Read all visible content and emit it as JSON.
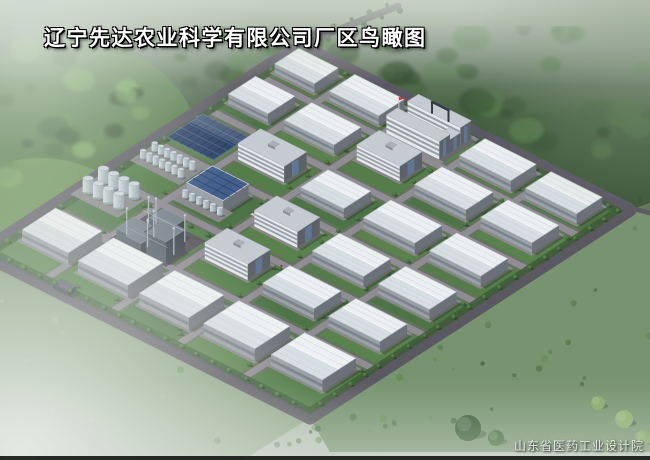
{
  "title": "辽宁先达农业科学有限公司厂区鸟瞰图",
  "credit": "山东省医药工业设计院",
  "palette": {
    "roadOuter": "#56525d",
    "roadInner": "#8e8a94",
    "siteBase": "#5e7054",
    "lawns": [
      "#4e7a42",
      "#477040",
      "#557f48"
    ],
    "hedge": "#36572e",
    "roofTop": "#f2f5f8",
    "roofBottom": "#dde3e9",
    "roofEdge": "#aeb5bd",
    "roofSeam": "#c6cdd5",
    "wallLight": "#9aa0a8",
    "wallDark": "#686d76",
    "windowBand": "#5d6570",
    "slabWall": "#eceef1",
    "slabEnd": "#575c64",
    "slabRoof": "#c9cfd5",
    "slabBand": "#828c97",
    "glass": "#5a7fa8",
    "solarDark": "#233a63",
    "solarLine": "#3b5e96",
    "solarGrid": "#16233f",
    "solarEdge": "#55688f",
    "panelRoof": "#3c5a8c",
    "panelSeam": "#24375c",
    "tankTop": "#d3dce3",
    "tankEdge": "#93a0ab",
    "tankBody2": "#8fa0ac",
    "plantMid": "#59626e",
    "plantDark": "#3c434d",
    "plantRoof": "#77818d",
    "pipe": "#a8b4c0",
    "courtyard": "#e9e2b0",
    "courtyardInner": "#d9cf92",
    "apron": "#8e8a92",
    "shadow": "rgba(22,32,22,0.32)",
    "forest": [
      "#263f24",
      "#2f4c2b",
      "#3a5a33",
      "#456a3a",
      "#52794a"
    ],
    "brightField": [
      "#55813f",
      "#68954f",
      "#7fae60"
    ],
    "fieldGreen": "#75926c",
    "bushGreens": [
      "#3f6436",
      "#4e7442",
      "#5d8a4a"
    ],
    "flagRed": "#d42b1f",
    "gateDark": "#2e333a",
    "fogPale": "#e6ece6"
  },
  "scene": {
    "transform": {
      "ox": 300,
      "oy": 45,
      "ax": 3.3,
      "ay": 1.65,
      "bx": -3.2,
      "by": 2.08
    },
    "roads_a": [
      18,
      38,
      58,
      78
    ],
    "roads_b": [
      14,
      30,
      46,
      62,
      78
    ],
    "grid_a": [
      0,
      18,
      38,
      58,
      78,
      100
    ],
    "grid_b": [
      0,
      14,
      30,
      46,
      62,
      78,
      100
    ],
    "buildings": [
      {
        "t": "wh",
        "a": 3,
        "b": 3.5,
        "w": 12,
        "d": 7.5,
        "h": 9
      },
      {
        "t": "wh",
        "a": 19.5,
        "b": 3,
        "w": 15,
        "d": 8,
        "h": 9
      },
      {
        "t": "wh",
        "a": 59,
        "b": 3,
        "w": 15.5,
        "d": 8,
        "h": 10
      },
      {
        "t": "wh",
        "a": 79,
        "b": 3,
        "w": 15.5,
        "d": 8,
        "h": 10
      },
      {
        "t": "wh",
        "a": 3,
        "b": 17,
        "w": 12,
        "d": 8.5,
        "h": 9
      },
      {
        "t": "wh",
        "a": 19.5,
        "b": 16.5,
        "w": 15,
        "d": 8.5,
        "h": 9
      },
      {
        "t": "slab",
        "a": 40,
        "b": 16.5,
        "w": 13,
        "d": 7,
        "h": 15
      },
      {
        "t": "wh",
        "a": 59,
        "b": 16.5,
        "w": 15.5,
        "d": 8.5,
        "h": 10
      },
      {
        "t": "wh",
        "a": 79,
        "b": 16.5,
        "w": 15.5,
        "d": 8.5,
        "h": 10
      },
      {
        "t": "slab",
        "a": 19.5,
        "b": 32.5,
        "w": 14,
        "d": 7,
        "h": 16
      },
      {
        "t": "wh",
        "a": 40,
        "b": 32.5,
        "w": 13,
        "d": 8.5,
        "h": 9
      },
      {
        "t": "wh",
        "a": 59,
        "b": 32.5,
        "w": 15.5,
        "d": 8.5,
        "h": 10
      },
      {
        "t": "wh",
        "a": 79,
        "b": 32.5,
        "w": 15.5,
        "d": 8.5,
        "h": 10
      },
      {
        "t": "slab",
        "a": 40,
        "b": 48.5,
        "w": 13,
        "d": 7,
        "h": 16
      },
      {
        "t": "wh",
        "a": 59,
        "b": 48.5,
        "w": 15.5,
        "d": 8.5,
        "h": 10
      },
      {
        "t": "wh",
        "a": 79,
        "b": 48.5,
        "w": 15.5,
        "d": 8.5,
        "h": 10
      },
      {
        "t": "slab",
        "a": 40,
        "b": 64,
        "w": 13,
        "d": 7,
        "h": 16
      },
      {
        "t": "wh",
        "a": 59,
        "b": 64,
        "w": 15.5,
        "d": 8.5,
        "h": 10
      },
      {
        "t": "wh",
        "a": 79,
        "b": 64,
        "w": 15.5,
        "d": 8.5,
        "h": 10
      },
      {
        "t": "whb",
        "a": 4,
        "b": 80.5,
        "w": 14,
        "d": 10.5,
        "h": 11
      },
      {
        "t": "whb",
        "a": 22,
        "b": 81,
        "w": 15,
        "d": 11,
        "h": 12
      },
      {
        "t": "whb",
        "a": 41,
        "b": 81.5,
        "w": 15,
        "d": 11,
        "h": 12
      },
      {
        "t": "whb",
        "a": 60,
        "b": 81,
        "w": 15.5,
        "d": 11,
        "h": 12
      },
      {
        "t": "whb",
        "a": 79.5,
        "b": 80.5,
        "w": 15.5,
        "d": 10.5,
        "h": 11
      }
    ],
    "office": {
      "a": 38,
      "b": 2.2,
      "w": 16,
      "slabD": 3.4,
      "gap": 3.2,
      "h": 18,
      "connW": 3.2,
      "connH": 13
    },
    "gate": {
      "a1": 40.5,
      "a2": 45.5,
      "h": 11
    },
    "solar": {
      "a": 1.5,
      "b": 32,
      "w": 14,
      "d": 11
    },
    "panelroof": {
      "a": 20,
      "b": 48,
      "w": 11,
      "d": 8,
      "h": 12
    },
    "plant": {
      "a": 19,
      "b": 66.5,
      "w": 16,
      "d": 11.5,
      "parts": [
        {
          "da": 0.5,
          "db": 5.5,
          "w": 5.5,
          "d": 5.5,
          "h": 10
        },
        {
          "da": 5,
          "db": 0.8,
          "w": 6.5,
          "d": 4.5,
          "h": 16
        },
        {
          "da": 9.5,
          "db": 5,
          "w": 6,
          "d": 6,
          "h": 21
        },
        {
          "da": 3.5,
          "db": 7.5,
          "w": 4.5,
          "d": 3.5,
          "h": 7
        }
      ],
      "columns": [
        [
          2,
          2.5
        ],
        [
          3.6,
          1.8
        ],
        [
          8,
          9
        ],
        [
          13,
          2.5
        ],
        [
          6.5,
          5.5
        ],
        [
          14.5,
          7.5
        ],
        [
          1.2,
          8.5
        ]
      ]
    },
    "tanks": [
      {
        "a": 3,
        "b": 48.5,
        "cols": 7,
        "rows": 2,
        "sx": 1.9,
        "sy": 3.6,
        "r": 0.85,
        "h": 8
      },
      {
        "a": 20.5,
        "b": 57,
        "cols": 6,
        "rows": 1,
        "sx": 2.1,
        "sy": 3.2,
        "r": 0.8,
        "h": 7
      },
      {
        "a": 2.5,
        "b": 64,
        "cols": 4,
        "rows": 2,
        "sx": 3.1,
        "sy": 4.8,
        "r": 1.5,
        "h": 14
      }
    ],
    "sideGate": {
      "a": 22,
      "b": 97.2,
      "w": 4.5,
      "d": 2.6,
      "h": 5
    },
    "cars": [
      {
        "a": 31,
        "b": 6.5,
        "c": "#e8eaec"
      },
      {
        "a": 33.2,
        "b": 6.5,
        "c": "#c2c8cd"
      },
      {
        "a": 41,
        "b": 46.8,
        "c": "#dfe2e5"
      },
      {
        "a": 36,
        "b": 52,
        "c": "#cdd2d6"
      }
    ],
    "figures": [
      {
        "a": 48,
        "b": 46.5,
        "c": "#33383d"
      },
      {
        "a": 30,
        "b": 78.5,
        "c": "#8a2a22"
      },
      {
        "a": 70,
        "b": 30.5,
        "c": "#33383d"
      },
      {
        "a": 55,
        "b": 62.5,
        "c": "#8a2a22"
      },
      {
        "a": 86,
        "b": 46.5,
        "c": "#33383d"
      }
    ],
    "fieldTrees": [
      {
        "x": 468,
        "y": 428,
        "r": 13,
        "c": "#2b5126"
      },
      {
        "x": 496,
        "y": 438,
        "r": 8,
        "c": "#376030"
      },
      {
        "x": 598,
        "y": 403,
        "r": 7,
        "c": "#84a85e"
      },
      {
        "x": 624,
        "y": 419,
        "r": 9,
        "c": "#8cb064"
      },
      {
        "x": 643,
        "y": 438,
        "r": 8,
        "c": "#7da257"
      },
      {
        "x": 610,
        "y": 446,
        "r": 6,
        "c": "#6f9850"
      }
    ],
    "forestRoad": {
      "x1": 300,
      "y1": 45,
      "x2": 398,
      "y2": 6
    },
    "rightRoad": {
      "x1": 630,
      "y1": 210,
      "x2": 652,
      "y2": 216
    }
  }
}
